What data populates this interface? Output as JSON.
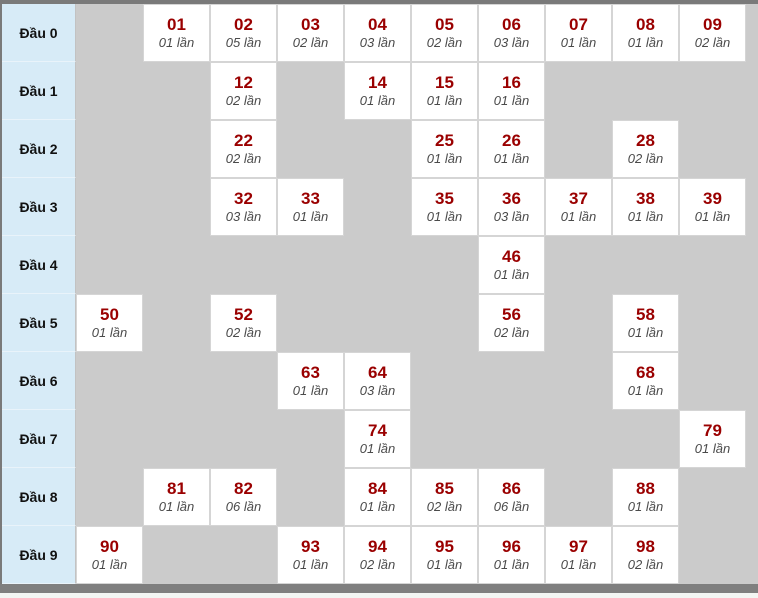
{
  "colors": {
    "page_bg": "#cbcbcb",
    "frame": "#7a7a7a",
    "scrollbar": "#7f7f7f",
    "header_bg": "#d7ebf7",
    "cell_bg": "#ffffff",
    "number": "#9a0000",
    "frequency_text": "#4a4a4a"
  },
  "table": {
    "unit_label": "lần",
    "rows": [
      {
        "label": "Đầu 0",
        "cells": [
          null,
          {
            "number": "01",
            "times": "01 lần"
          },
          {
            "number": "02",
            "times": "05 lần"
          },
          {
            "number": "03",
            "times": "02 lần"
          },
          {
            "number": "04",
            "times": "03 lần"
          },
          {
            "number": "05",
            "times": "02 lần"
          },
          {
            "number": "06",
            "times": "03 lần"
          },
          {
            "number": "07",
            "times": "01 lần"
          },
          {
            "number": "08",
            "times": "01 lần"
          },
          {
            "number": "09",
            "times": "02 lần"
          }
        ]
      },
      {
        "label": "Đầu 1",
        "cells": [
          null,
          null,
          {
            "number": "12",
            "times": "02 lần"
          },
          null,
          {
            "number": "14",
            "times": "01 lần"
          },
          {
            "number": "15",
            "times": "01 lần"
          },
          {
            "number": "16",
            "times": "01 lần"
          },
          null,
          null,
          null
        ]
      },
      {
        "label": "Đầu 2",
        "cells": [
          null,
          null,
          {
            "number": "22",
            "times": "02 lần"
          },
          null,
          null,
          {
            "number": "25",
            "times": "01 lần"
          },
          {
            "number": "26",
            "times": "01 lần"
          },
          null,
          {
            "number": "28",
            "times": "02 lần"
          },
          null
        ]
      },
      {
        "label": "Đầu 3",
        "cells": [
          null,
          null,
          {
            "number": "32",
            "times": "03 lần"
          },
          {
            "number": "33",
            "times": "01 lần"
          },
          null,
          {
            "number": "35",
            "times": "01 lần"
          },
          {
            "number": "36",
            "times": "03 lần"
          },
          {
            "number": "37",
            "times": "01 lần"
          },
          {
            "number": "38",
            "times": "01 lần"
          },
          {
            "number": "39",
            "times": "01 lần"
          }
        ]
      },
      {
        "label": "Đầu 4",
        "cells": [
          null,
          null,
          null,
          null,
          null,
          null,
          {
            "number": "46",
            "times": "01 lần"
          },
          null,
          null,
          null
        ]
      },
      {
        "label": "Đầu 5",
        "cells": [
          {
            "number": "50",
            "times": "01 lần"
          },
          null,
          {
            "number": "52",
            "times": "02 lần"
          },
          null,
          null,
          null,
          {
            "number": "56",
            "times": "02 lần"
          },
          null,
          {
            "number": "58",
            "times": "01 lần"
          },
          null
        ]
      },
      {
        "label": "Đầu 6",
        "cells": [
          null,
          null,
          null,
          {
            "number": "63",
            "times": "01 lần"
          },
          {
            "number": "64",
            "times": "03 lần"
          },
          null,
          null,
          null,
          {
            "number": "68",
            "times": "01 lần"
          },
          null
        ]
      },
      {
        "label": "Đầu 7",
        "cells": [
          null,
          null,
          null,
          null,
          {
            "number": "74",
            "times": "01 lần"
          },
          null,
          null,
          null,
          null,
          {
            "number": "79",
            "times": "01 lần"
          }
        ]
      },
      {
        "label": "Đầu 8",
        "cells": [
          null,
          {
            "number": "81",
            "times": "01 lần"
          },
          {
            "number": "82",
            "times": "06 lần"
          },
          null,
          {
            "number": "84",
            "times": "01 lần"
          },
          {
            "number": "85",
            "times": "02 lần"
          },
          {
            "number": "86",
            "times": "06 lần"
          },
          null,
          {
            "number": "88",
            "times": "01 lần"
          },
          null
        ]
      },
      {
        "label": "Đầu 9",
        "cells": [
          {
            "number": "90",
            "times": "01 lần"
          },
          null,
          null,
          {
            "number": "93",
            "times": "01 lần"
          },
          {
            "number": "94",
            "times": "02 lần"
          },
          {
            "number": "95",
            "times": "01 lần"
          },
          {
            "number": "96",
            "times": "01 lần"
          },
          {
            "number": "97",
            "times": "01 lần"
          },
          {
            "number": "98",
            "times": "02 lần"
          },
          null
        ]
      }
    ]
  }
}
